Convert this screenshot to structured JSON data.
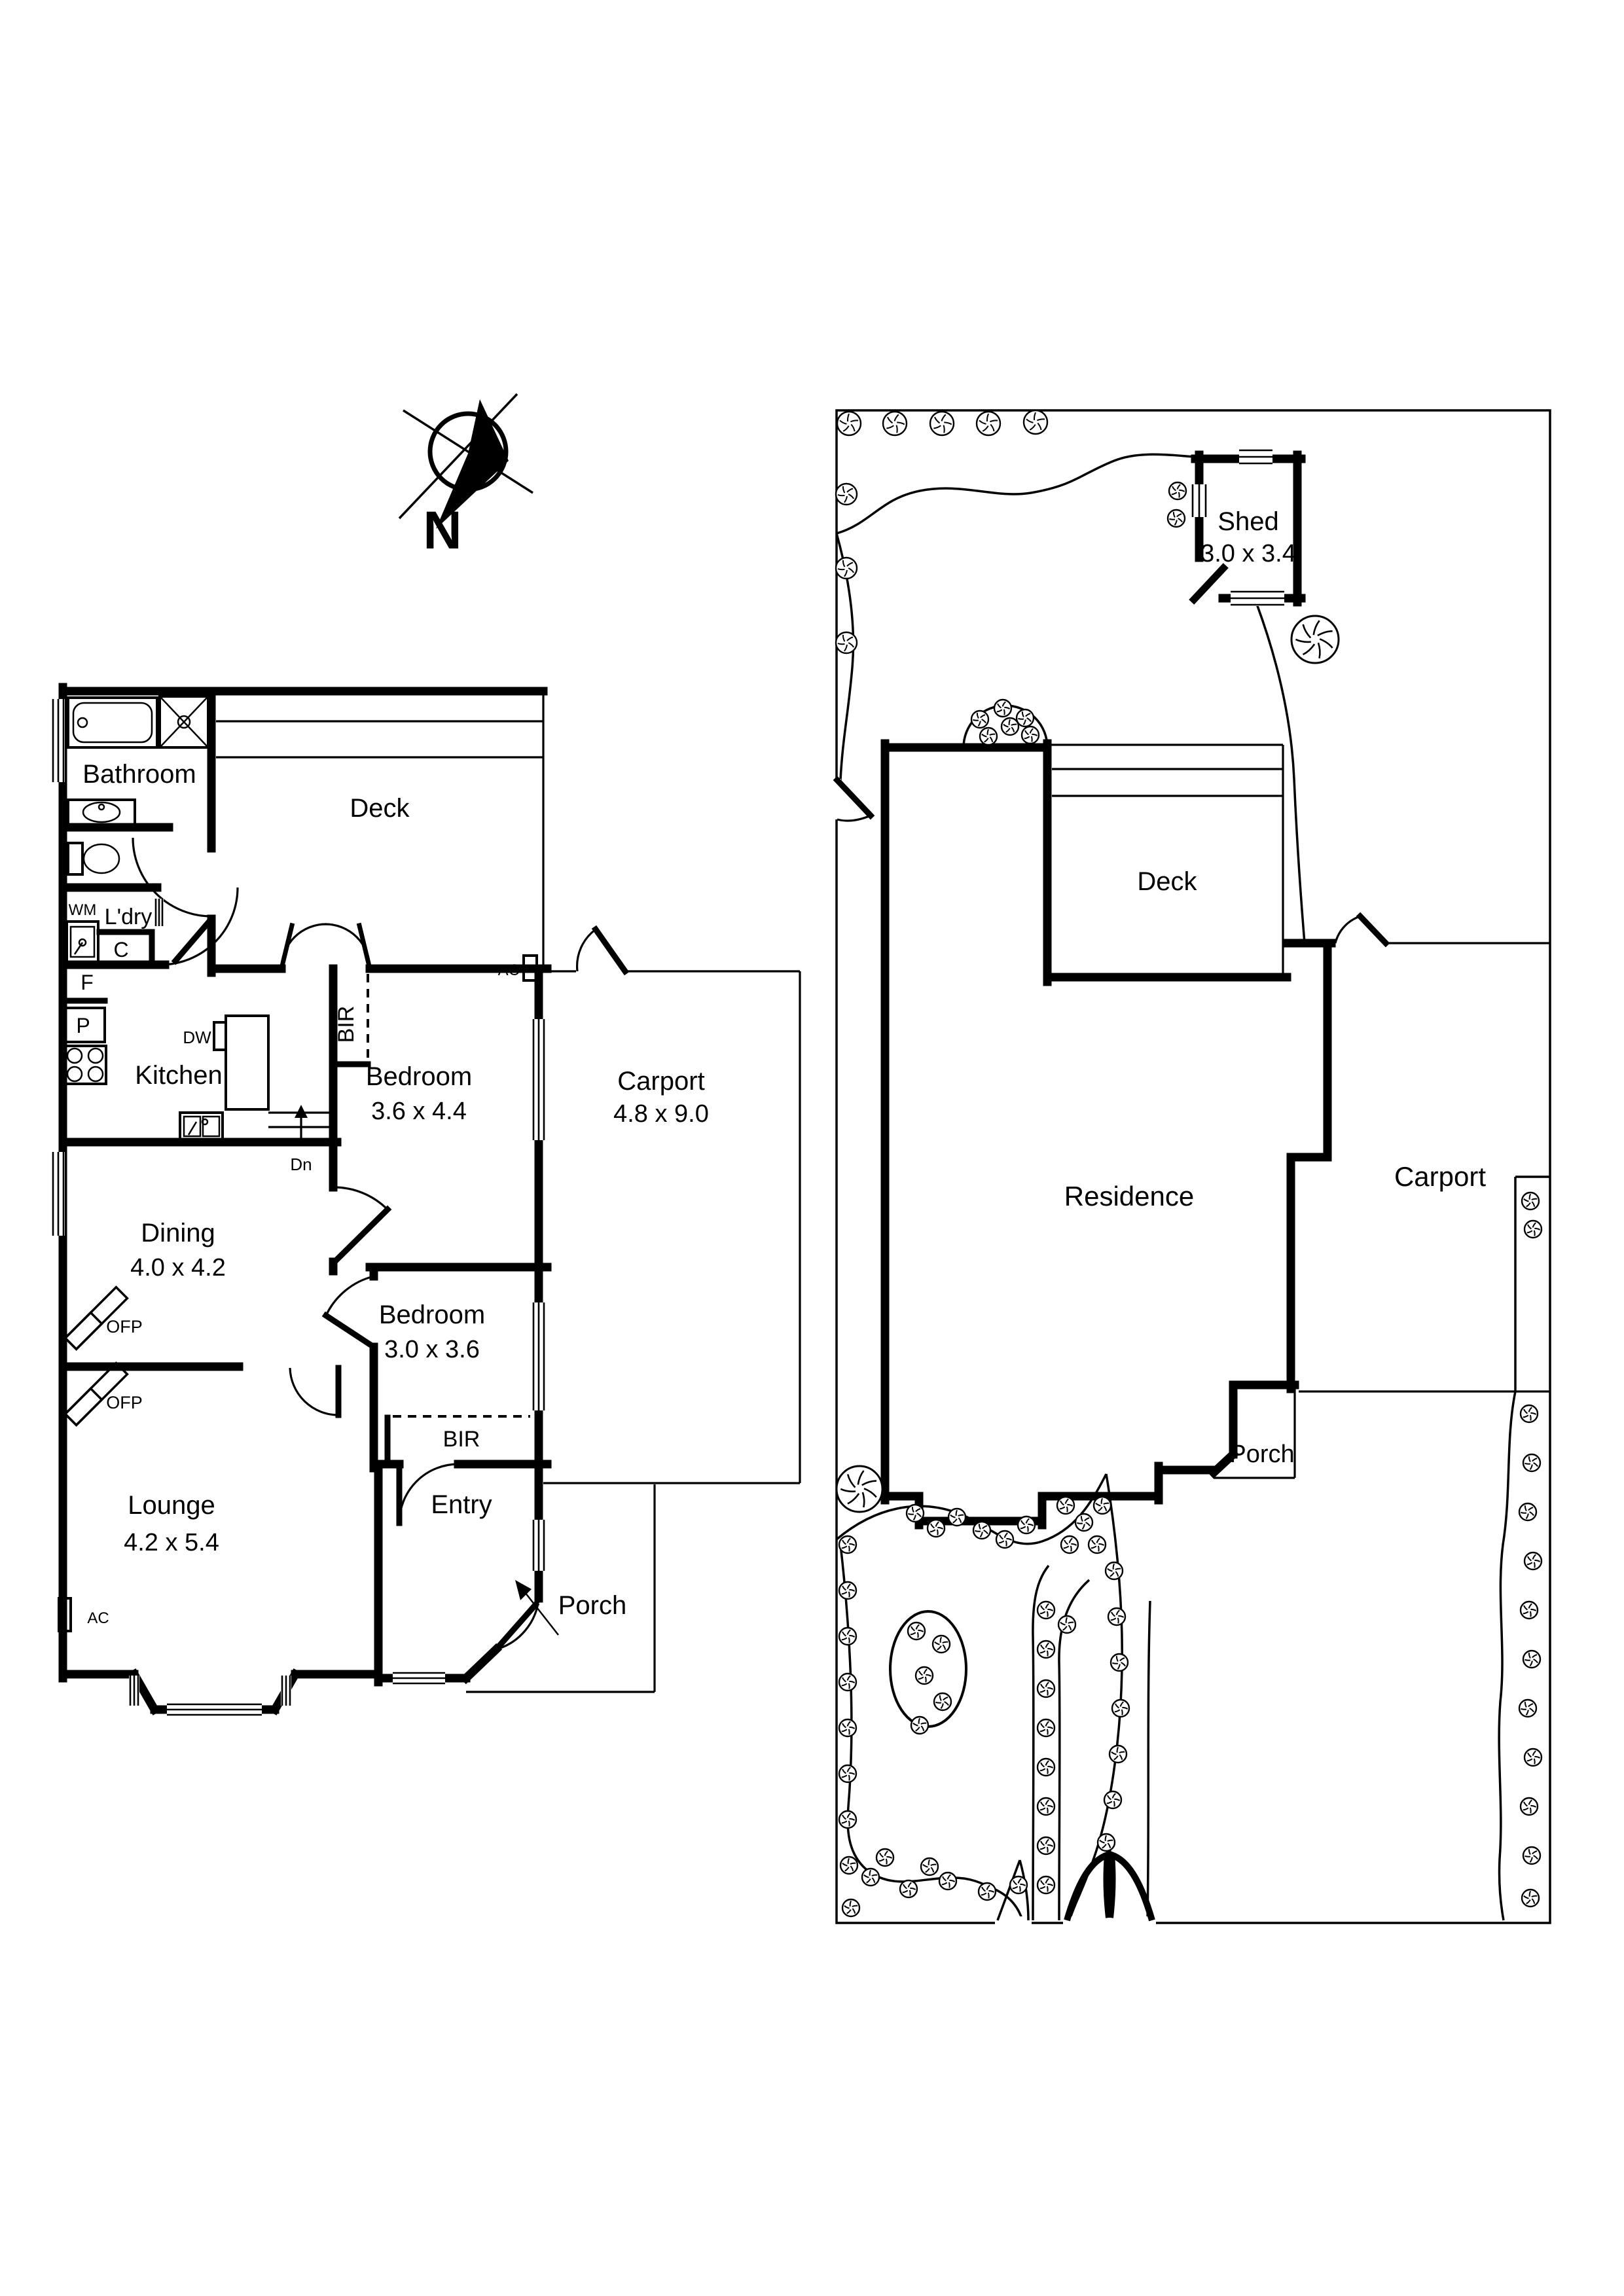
{
  "compass": {
    "label": "N"
  },
  "floor_plan": {
    "bathroom": "Bathroom",
    "laundry": "L'dry",
    "wm": "WM",
    "cupboard": "C",
    "fridge": "F",
    "pantry": "P",
    "dishwasher": "DW",
    "kitchen": "Kitchen",
    "stairs": "Dn",
    "deck": "Deck",
    "bir": "BIR",
    "ofp": "OFP",
    "ac": "AC",
    "bedroom1": {
      "name": "Bedroom",
      "dims": "3.6 x 4.4"
    },
    "bedroom2": {
      "name": "Bedroom",
      "dims": "3.0 x 3.6"
    },
    "dining": {
      "name": "Dining",
      "dims": "4.0 x 4.2"
    },
    "lounge": {
      "name": "Lounge",
      "dims": "4.2 x 5.4"
    },
    "carport": {
      "name": "Carport",
      "dims": "4.8 x 9.0"
    },
    "entry": "Entry",
    "porch": "Porch"
  },
  "site_plan": {
    "shed": {
      "name": "Shed",
      "dims": "3.0 x 3.4"
    },
    "deck": "Deck",
    "residence": "Residence",
    "carport": "Carport",
    "porch": "Porch"
  }
}
